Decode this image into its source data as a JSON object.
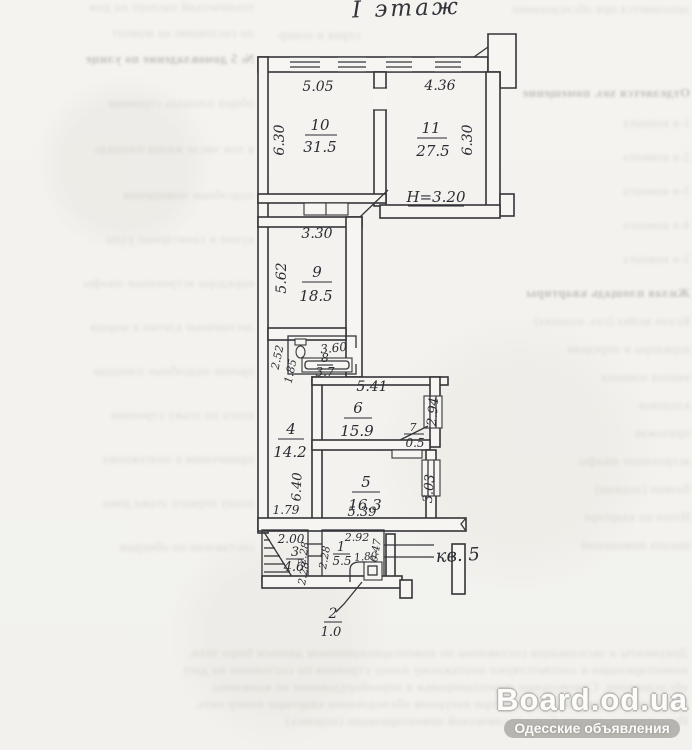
{
  "page": {
    "title": "I этаж"
  },
  "plan": {
    "apartment": "кв. 5",
    "height_note": "H=3.20",
    "rooms": {
      "r10": {
        "num": "10",
        "area": "31.5",
        "w": "5.05",
        "h": "6.30"
      },
      "r11": {
        "num": "11",
        "area": "27.5",
        "w": "4.36",
        "h": "6.30"
      },
      "r9": {
        "num": "9",
        "area": "18.5",
        "w": "3.30",
        "h": "5.62"
      },
      "r8": {
        "num": "8",
        "area": "3.7",
        "w": "3.60",
        "d1": "2.52",
        "d2": "1.85"
      },
      "r6": {
        "num": "6",
        "area": "15.9",
        "w": "5.41",
        "h": "2.94"
      },
      "r7": {
        "num": "7",
        "area": "0.5"
      },
      "r4": {
        "num": "4",
        "area": "14.2",
        "h": "6.40",
        "d1": "1.79"
      },
      "r5": {
        "num": "5",
        "area": "16.3",
        "w": "5.39",
        "h": "3.03"
      },
      "r3": {
        "num": "3",
        "area": "4.6",
        "w": "2.00",
        "d1": "2.28",
        "d2": "2.28"
      },
      "r1": {
        "num": "1",
        "area": "5.5",
        "w": "2.92",
        "d1": "2.28",
        "d2": "1.80",
        "d3": "0.47"
      },
      "r2": {
        "num": "2",
        "area": "1.0"
      }
    }
  },
  "ghost": {
    "top": [
      "заполняется при обследовании",
      "серия и номер"
    ],
    "right": [
      "Отделяется хоз. помещение",
      "1-я комната",
      "2-я комната",
      "3-я комната",
      "4-я комната",
      "5-я комната",
      "Жилая площадь квартиры",
      "Кухня мойка (газ. колонка)",
      "коридоры и передняя",
      "ванная комната",
      "кладовая",
      "прихожая",
      "встроенные шкафы",
      "балкон (лоджия)",
      "Итого по квартире",
      "высота помещений"
    ],
    "left": [
      "технический паспорт на дом",
      "по состоянию на момент",
      "№ 5 домовладение по улице",
      "общая площадь строения",
      "в том числе жилая площадь",
      "подсобные помещения",
      "кухни и санитарные узлы",
      "коридоры встроенные шкафы",
      "лестничные клетки и марши",
      "прочие подсобные площади",
      "итого по этажу строения",
      "примечания к поэтажному",
      "плану первого этажа дома",
      "составлено по обмерам"
    ],
    "bottom": [
      "Документы и экспликация составлены по инвентаризационным данным бюро техн.",
      "инвентаризации и соответствуют поэтажному плану строения по состоянию на дату",
      "обследования. Самовольные перепланировки и переоборудование не выявлены.",
      "Площади помещений уточнены при натурном обследовании квартиры номер пять.",
      "Исполнитель: техник бюро технической инвентаризации (подпись)"
    ]
  },
  "watermark": {
    "site": "Board.od.ua",
    "tagline": "Одесские объявления"
  }
}
